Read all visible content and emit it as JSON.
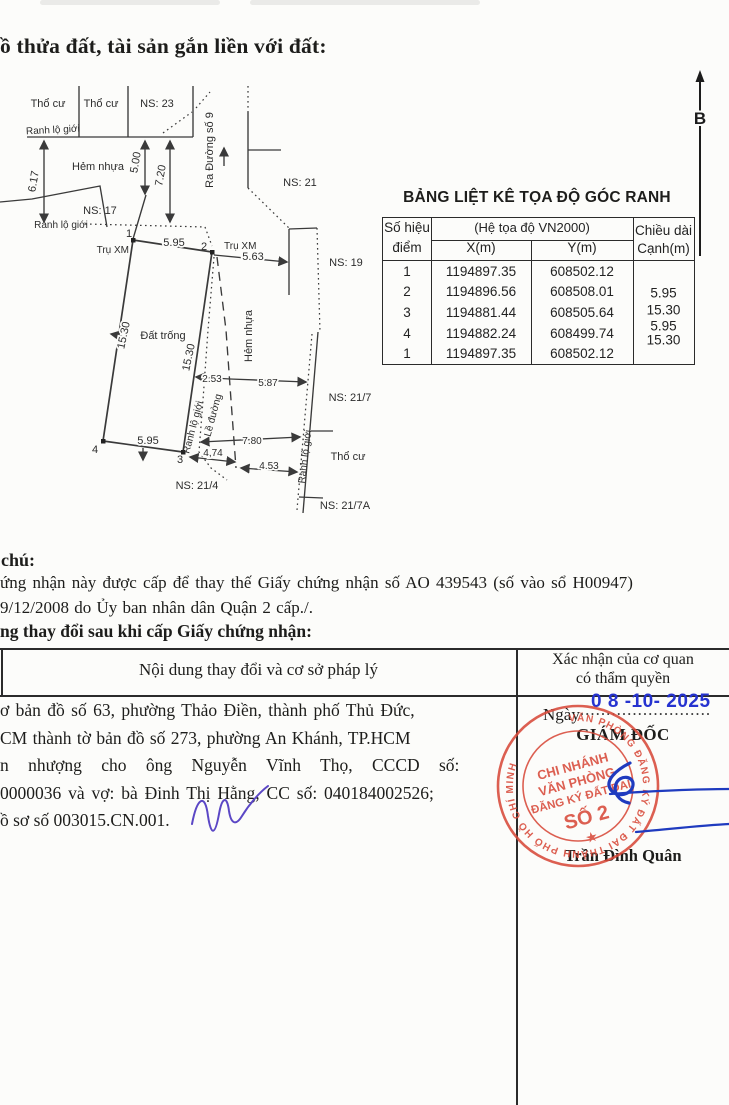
{
  "page": {
    "title": "ồ thửa đất, tài sản gắn liền với đất:"
  },
  "north": {
    "label": "B"
  },
  "map": {
    "labels": {
      "tho_cu_1": "Thổ cư",
      "tho_cu_2": "Thổ cư",
      "ns23": "NS: 23",
      "ranh_lo_gioi_top": "Ranh lộ giới",
      "hem_nhua_top": "Hẻm nhựa",
      "ns17": "NS: 17",
      "ranh_lo_gioi_left": "Ranh lộ giới",
      "ra_duong_so_9": "Ra Đường số 9",
      "ns21": "NS: 21",
      "ns19": "NS: 19",
      "tru_xm_1": "Trụ XM",
      "tru_xm_2": "Trụ XM",
      "dat_trong": "Đất trống",
      "hem_nhua_mid": "Hẻm nhựa",
      "ranh_lo_gioi_mid": "Ranh lộ giới",
      "le_duong": "Lề đường",
      "ranh_lo_gioi_right": "Ranh lộ giới",
      "ns217": "NS: 21/7",
      "ns214": "NS: 21/4",
      "ns217a": "NS: 21/7A",
      "tho_cu_right": "Thổ cư",
      "p1": "1",
      "p2": "2",
      "p3": "3",
      "p4": "4"
    },
    "dims": {
      "d617": "6.17",
      "d500": "5.00",
      "d720": "7.20",
      "d595top": "5.95",
      "d563": "5.63",
      "d1530left": "15.30",
      "d1530right": "15.30",
      "d253": "2.53",
      "d587": "5.87",
      "d595bot": "5.95",
      "d780": "7.80",
      "d474": "4,74",
      "d453": "4.53"
    }
  },
  "coords_table": {
    "title": "BẢNG LIỆT KÊ TỌA ĐỘ GÓC RANH",
    "header": {
      "point_l1": "Số hiệu",
      "point_l2": "điểm",
      "system": "(Hệ tọa độ VN2000)",
      "x": "X(m)",
      "y": "Y(m)",
      "len_l1": "Chiều dài",
      "len_l2": "Cạnh(m)"
    },
    "rows": [
      {
        "id": "1",
        "x": "1194897.35",
        "y": "608502.12"
      },
      {
        "id": "2",
        "x": "1194896.56",
        "y": "608508.01"
      },
      {
        "id": "3",
        "x": "1194881.44",
        "y": "608505.64"
      },
      {
        "id": "4",
        "x": "1194882.24",
        "y": "608499.74"
      },
      {
        "id": "1",
        "x": "1194897.35",
        "y": "608502.12"
      }
    ],
    "lengths": [
      "5.95",
      "15.30",
      "5.95",
      "15.30"
    ]
  },
  "notes": {
    "label": "chú:",
    "line1": "ứng nhận này được cấp để thay thế Giấy chứng nhận số AO 439543 (số vào sổ H00947)",
    "line2": "9/12/2008 do Ủy ban nhân dân Quận 2 cấp./.",
    "changes_heading": "ng thay đổi sau khi cấp Giấy chứng nhận:"
  },
  "changes_table": {
    "col1_header": "Nội dung thay đổi và cơ sở pháp lý",
    "col2_header_l1": "Xác nhận của cơ quan",
    "col2_header_l2": "có thẩm quyền",
    "content": [
      "ơ bản đồ số 63, phường Thảo Điền, thành phố Thủ Đức,",
      "CM thành tờ bản đồ số 273, phường An Khánh, TP.HCM",
      "n nhượng cho ông Nguyễn Vĩnh Thọ, CCCD số:",
      "0000036 và vợ: bà Đinh Thị Hằng, CC số: 040184002526;",
      "ồ sơ số 003015.CN.001."
    ],
    "confirm": {
      "ngay": "Ngày",
      "date_stamp": "0 8 -10- 2025",
      "director": "GIÁM ĐỐC",
      "signer": "Trần Đình Quân"
    },
    "stamp": {
      "ring": "VĂN PHÒNG ĐĂNG KÝ ĐẤT ĐAI THÀNH PHỐ HỒ CHÍ MINH",
      "l1": "CHI NHÁNH",
      "l2": "VĂN PHÒNG",
      "l3": "ĐĂNG KÝ ĐẤT ĐAI",
      "l4": "SỐ 2",
      "star": "★"
    }
  },
  "colors": {
    "stamp_red": "#d84a3a",
    "ink_blue": "#1f3bbf",
    "date_blue": "#2633d0",
    "sig_purple": "#5b47c5"
  }
}
